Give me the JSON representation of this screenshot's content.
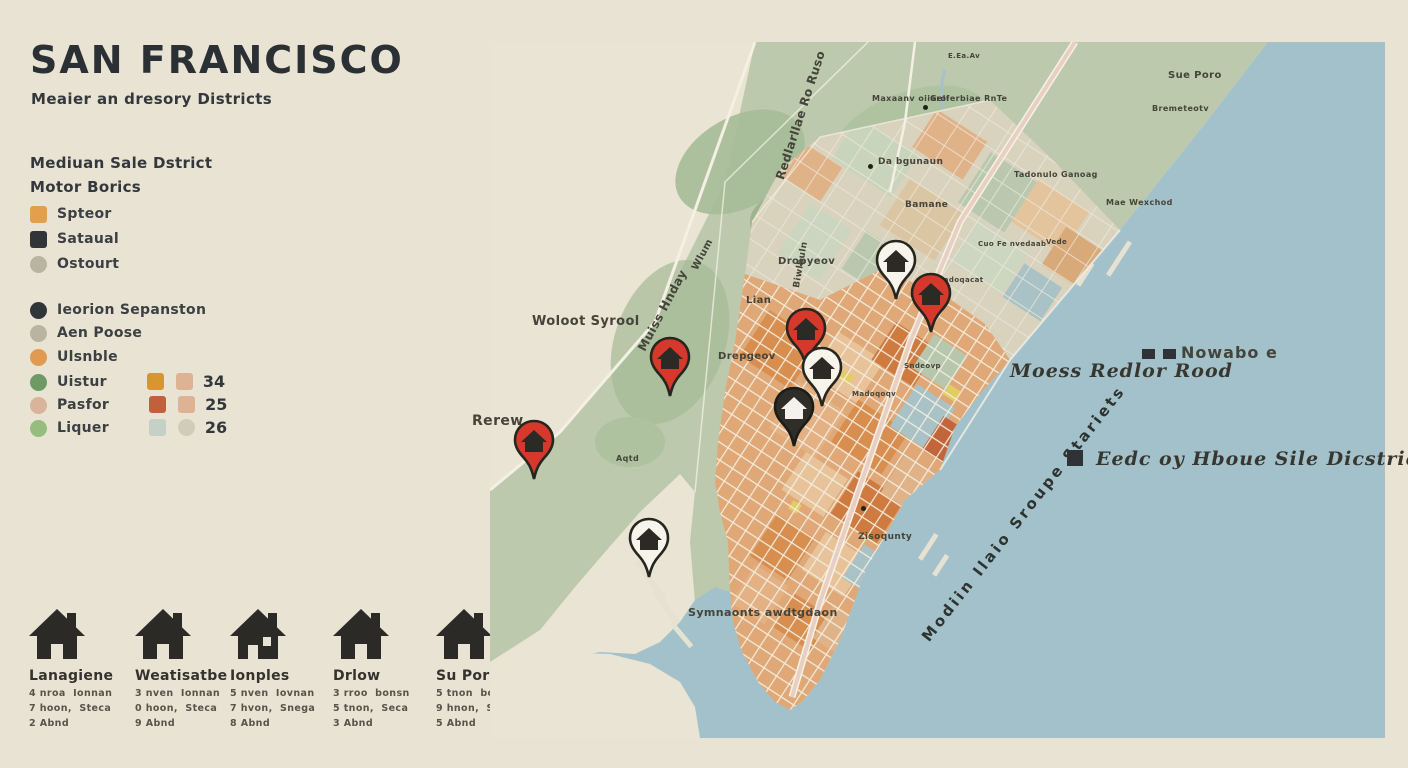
{
  "header": {
    "title": "SAN FRANCISCO",
    "subtitle": "Meaier an dresory Districts"
  },
  "legend1": {
    "heading_line1": "Mediuan Sale Dstrict",
    "heading_line2": "Motor Borics",
    "items": [
      {
        "label": "Spteor",
        "shape": "square",
        "color": "#e2a04c"
      },
      {
        "label": "Sataual",
        "shape": "square",
        "color": "#30353a"
      },
      {
        "label": "Ostourt",
        "shape": "circle",
        "color": "#b9b4a2"
      }
    ]
  },
  "legend2": {
    "items": [
      {
        "label": "Ieorion Sepanston",
        "shape": "circle",
        "color": "#30353a"
      },
      {
        "label": "Aen Poose",
        "shape": "circle",
        "color": "#b9b4a2"
      },
      {
        "label": "Ulsnble",
        "shape": "circle",
        "color": "#e09a52"
      },
      {
        "label": "Uistur",
        "shape": "circle",
        "color": "#6f9a63",
        "chip1": "#d9952f",
        "chip2": "#ddb394",
        "chip2_shape": "square",
        "value": "34"
      },
      {
        "label": "Pasfor",
        "shape": "circle",
        "color": "#d9b39a",
        "chip1": "#c2603b",
        "chip2": "#ddb394",
        "chip2_shape": "square",
        "value": "25"
      },
      {
        "label": "Liquer",
        "shape": "circle",
        "color": "#95bd7e",
        "chip1": "#c5d0c6",
        "chip2": "#cfccba",
        "chip2_shape": "circle",
        "value": "26"
      }
    ]
  },
  "houses": [
    {
      "name": "Lanagiene",
      "line1": "4 nroa  Ionnan",
      "line2": "7 hoon,  Steca",
      "line3": "2 Abnd"
    },
    {
      "name": "Weatisatbe",
      "line1": "3 nven  Ionnan",
      "line2": "0 hoon,  Steca",
      "line3": "9 Abnd"
    },
    {
      "name": "Ionples",
      "line1": "5 nven  Iovnan",
      "line2": "7 hvon,  Snega",
      "line3": "8 Abnd"
    },
    {
      "name": "Drlow",
      "line1": "3 rroo  bonsn",
      "line2": "5 tnon,  Seca",
      "line3": "3 Abnd"
    },
    {
      "name": "Su Porr",
      "line1": "5 tnon  bonan",
      "line2": "9 hnon,  Stesa",
      "line3": "5 Abnd"
    }
  ],
  "map": {
    "colors": {
      "water": "#a3c1cb",
      "land_green": "#bcc9ac",
      "city_orange": "#e0a876",
      "road_pink": "#e9cfc3",
      "pin_red": "#d6392c",
      "pin_white": "#f7f4ec",
      "pin_black": "#2e2d28"
    },
    "annotations": {
      "nowabo": "Nowabo e",
      "redlor_road": "Moess Redlor Rood",
      "eedc": "Eedc oy Hboue Sile Dicstries",
      "water_name": "Modiin Ilaio Sroupe Stariets"
    },
    "labels": [
      {
        "text": "Redlarllae Ro Ruso",
        "x": 283,
        "y": 135,
        "size": 12,
        "rot": -72
      },
      {
        "text": "Muiss Hnday",
        "x": 145,
        "y": 305,
        "size": 12,
        "rot": -62
      },
      {
        "text": "Wlum",
        "x": 200,
        "y": 225,
        "size": 10,
        "rot": -62
      },
      {
        "text": "Biwlbuln",
        "x": 302,
        "y": 245,
        "size": 9,
        "rot": -80
      },
      {
        "text": "Dropyeov",
        "x": 288,
        "y": 214,
        "size": 10,
        "rot": 0
      },
      {
        "text": "Lian",
        "x": 256,
        "y": 253,
        "size": 10,
        "rot": 0
      },
      {
        "text": "Drepgeov",
        "x": 228,
        "y": 309,
        "size": 10,
        "rot": 0
      },
      {
        "text": "Woloot Syrool",
        "x": 42,
        "y": 272,
        "size": 13,
        "rot": 0
      },
      {
        "text": "Rerew",
        "x": -18,
        "y": 371,
        "size": 14,
        "rot": 0
      },
      {
        "text": "Aqtd",
        "x": 126,
        "y": 412,
        "size": 8,
        "rot": 0
      },
      {
        "text": "E.Ea.Av",
        "x": 458,
        "y": 10,
        "size": 7,
        "rot": 0
      },
      {
        "text": "Maxaanv oiiaroi",
        "x": 382,
        "y": 52,
        "size": 8,
        "rot": 0
      },
      {
        "text": "Gelferbiae RnTe",
        "x": 440,
        "y": 52,
        "size": 8,
        "rot": 0
      },
      {
        "text": "Da bgunaun",
        "x": 388,
        "y": 115,
        "size": 9,
        "rot": 0
      },
      {
        "text": "Bamane",
        "x": 415,
        "y": 158,
        "size": 9,
        "rot": 0
      },
      {
        "text": "Sue Poro",
        "x": 678,
        "y": 28,
        "size": 10,
        "rot": 0
      },
      {
        "text": "Bremeteotv",
        "x": 662,
        "y": 62,
        "size": 8,
        "rot": 0
      },
      {
        "text": "Tadonulo Ganoag",
        "x": 524,
        "y": 128,
        "size": 8,
        "rot": 0
      },
      {
        "text": "Mae Wexchod",
        "x": 616,
        "y": 156,
        "size": 8,
        "rot": 0
      },
      {
        "text": "Cuo Fe nvedaab",
        "x": 488,
        "y": 198,
        "size": 7,
        "rot": 0
      },
      {
        "text": "Vede",
        "x": 556,
        "y": 196,
        "size": 7,
        "rot": 0
      },
      {
        "text": "Radoqacat",
        "x": 448,
        "y": 234,
        "size": 7,
        "rot": 0
      },
      {
        "text": "Sndeovp",
        "x": 414,
        "y": 320,
        "size": 7,
        "rot": 0
      },
      {
        "text": "Madoqoqv",
        "x": 362,
        "y": 348,
        "size": 7,
        "rot": 0
      },
      {
        "text": "Zisoqunty",
        "x": 368,
        "y": 490,
        "size": 9,
        "rot": 0
      },
      {
        "text": "Symnaonts awdtgdaon",
        "x": 198,
        "y": 564,
        "size": 11,
        "rot": 0
      }
    ],
    "dots": [
      {
        "x": 378,
        "y": 122
      },
      {
        "x": 433,
        "y": 63
      },
      {
        "x": 371,
        "y": 464
      }
    ],
    "pins": [
      {
        "x": 406,
        "y": 223,
        "type": "white"
      },
      {
        "x": 441,
        "y": 256,
        "type": "red"
      },
      {
        "x": 316,
        "y": 291,
        "type": "red"
      },
      {
        "x": 180,
        "y": 320,
        "type": "red"
      },
      {
        "x": 332,
        "y": 330,
        "type": "white"
      },
      {
        "x": 304,
        "y": 370,
        "type": "black"
      },
      {
        "x": 44,
        "y": 403,
        "type": "red"
      },
      {
        "x": 159,
        "y": 501,
        "type": "white"
      }
    ]
  }
}
